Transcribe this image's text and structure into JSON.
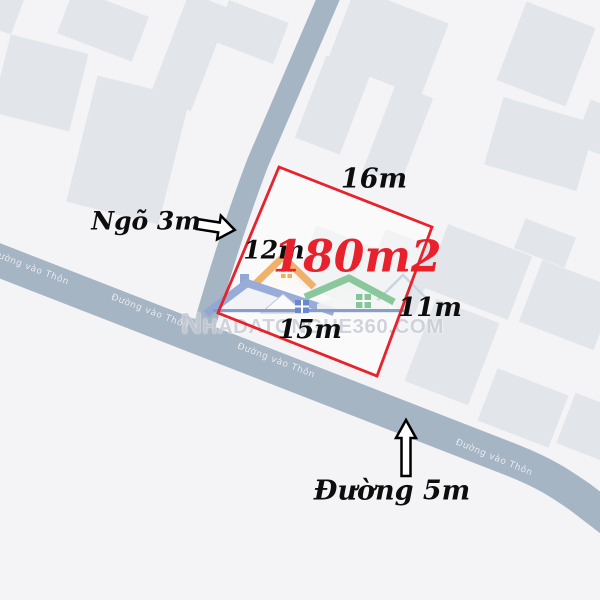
{
  "plot": {
    "area_label": "180m2",
    "dimensions": {
      "top": "16m",
      "left": "12m",
      "right": "11m",
      "bottom": "15m"
    }
  },
  "callouts": {
    "alley": "Ngõ 3m",
    "main_road": "Đường 5m"
  },
  "map": {
    "road_name": "Đường vào Thôn"
  },
  "watermark": {
    "site": "NHADATONGHE360.COM"
  },
  "colors": {
    "accent_red": "#e7222c",
    "road": "#a6b5c4",
    "building": "#e2e5ea",
    "background": "#f4f4f6",
    "watermark_gray": "#c6ccd4"
  }
}
